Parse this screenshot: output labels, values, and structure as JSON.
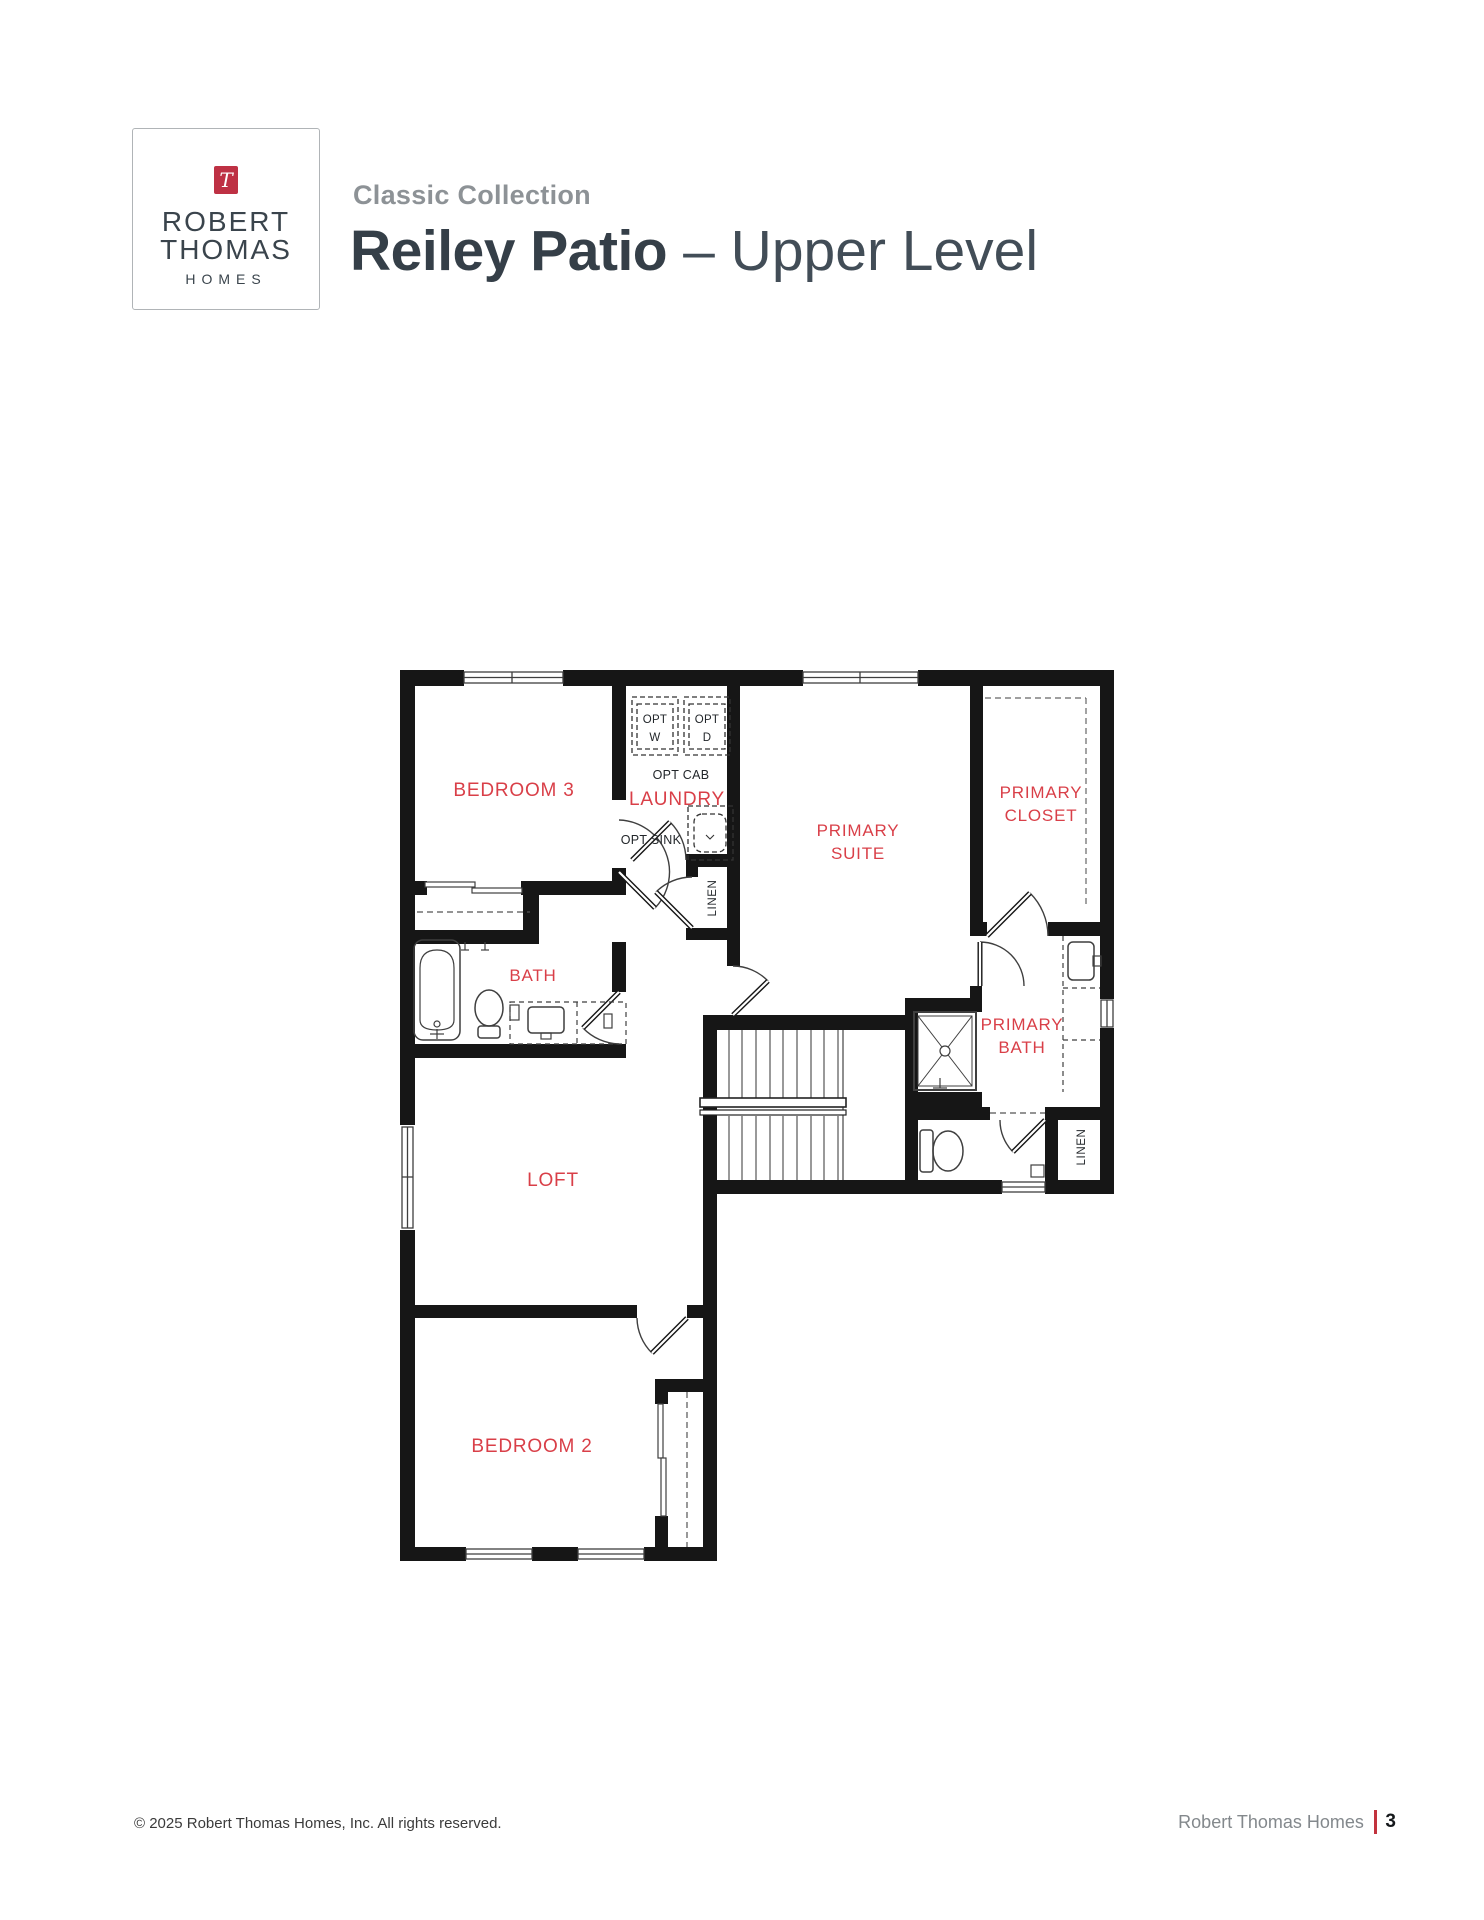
{
  "header": {
    "logo": {
      "monogram": "T",
      "line1": "ROBERT",
      "line2": "THOMAS",
      "line3": "HOMES",
      "accent_color": "#BE3144"
    },
    "collection": "Classic Collection",
    "plan_name": "Reiley Patio",
    "level_suffix": "– Upper Level"
  },
  "plan": {
    "label_color": "#D93F48",
    "rooms": {
      "bedroom3": "BEDROOM 3",
      "laundry": "LAUNDRY",
      "primary_suite_line1": "PRIMARY",
      "primary_suite_line2": "SUITE",
      "primary_closet_line1": "PRIMARY",
      "primary_closet_line2": "CLOSET",
      "bath": "BATH",
      "primary_bath_line1": "PRIMARY",
      "primary_bath_line2": "BATH",
      "loft": "LOFT",
      "bedroom2": "BEDROOM 2",
      "linen_hall": "LINEN",
      "linen_primary": "LINEN"
    },
    "options": {
      "washer_line1": "OPT",
      "washer_line2": "W",
      "dryer_line1": "OPT",
      "dryer_line2": "D",
      "cabinet": "OPT CAB",
      "sink": "OPT SINK"
    }
  },
  "footer": {
    "copyright": "© 2025 Robert Thomas Homes, Inc. All rights reserved.",
    "brand": "Robert Thomas Homes",
    "page_number": "3",
    "divider_color": "#C2333E"
  }
}
